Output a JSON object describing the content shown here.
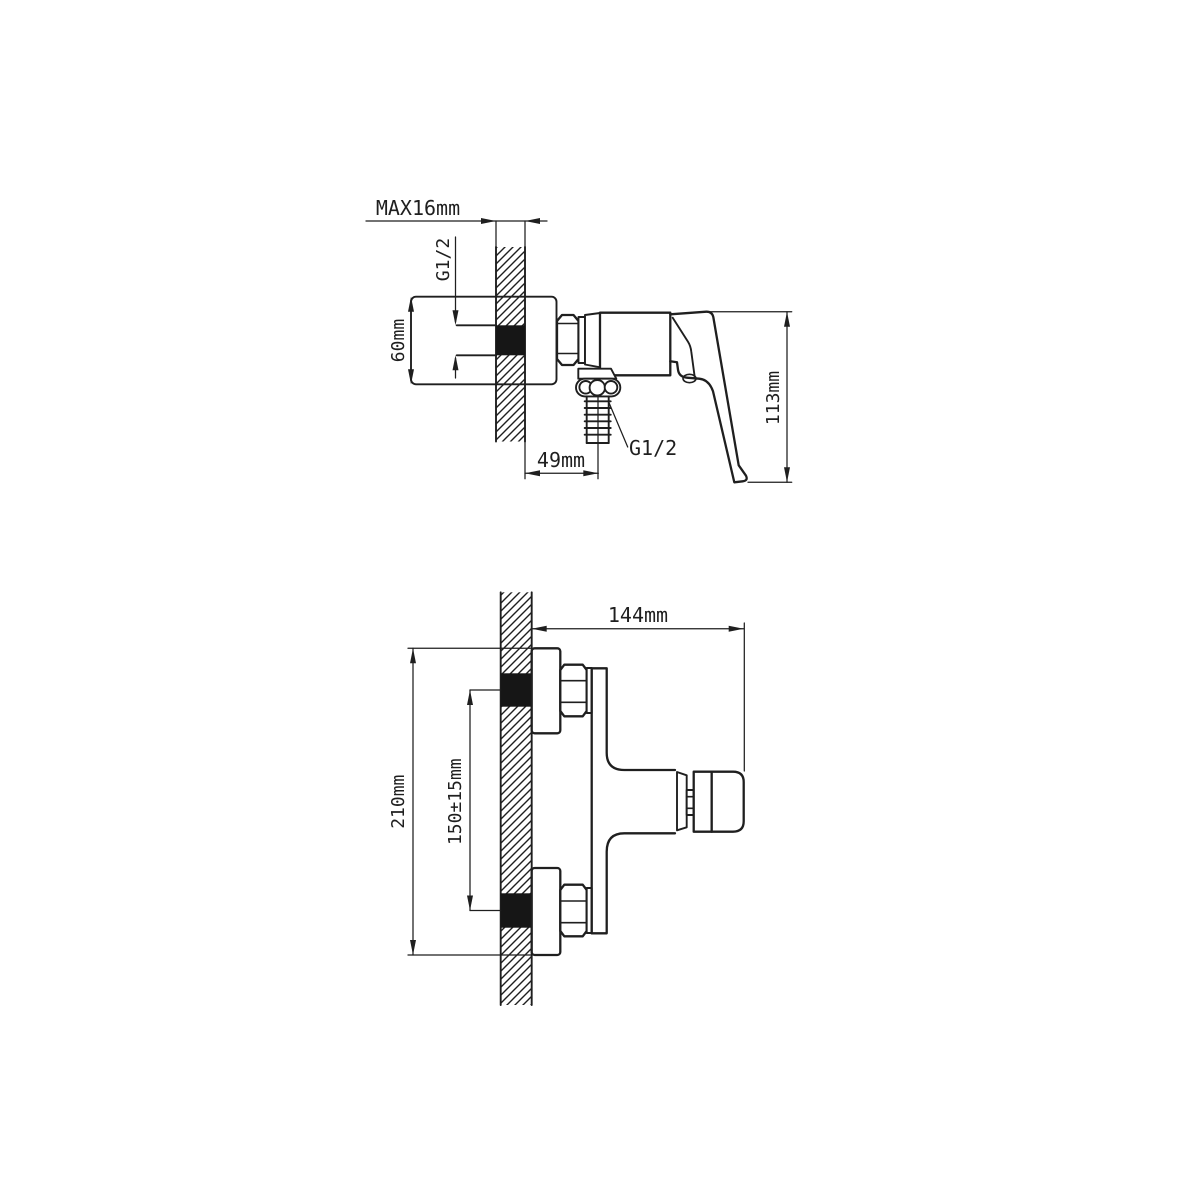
{
  "page": {
    "title": "Shower mixer installation drawing",
    "background": "#ffffff",
    "line_color": "#1f1f1f",
    "plug_fill": "#161616"
  },
  "side_view": {
    "name": "side elevation with wall section",
    "labels": {
      "max_wall": "MAX16mm",
      "inlet_thread": "G1/2",
      "flange": "60mm",
      "outlet_offset": "49mm",
      "outlet_thread": "G1/2",
      "height": "113mm"
    }
  },
  "front_view": {
    "name": "plan view with wall section",
    "labels": {
      "depth": "144mm",
      "total_height": "210mm",
      "center_distance": "150±15mm"
    }
  }
}
